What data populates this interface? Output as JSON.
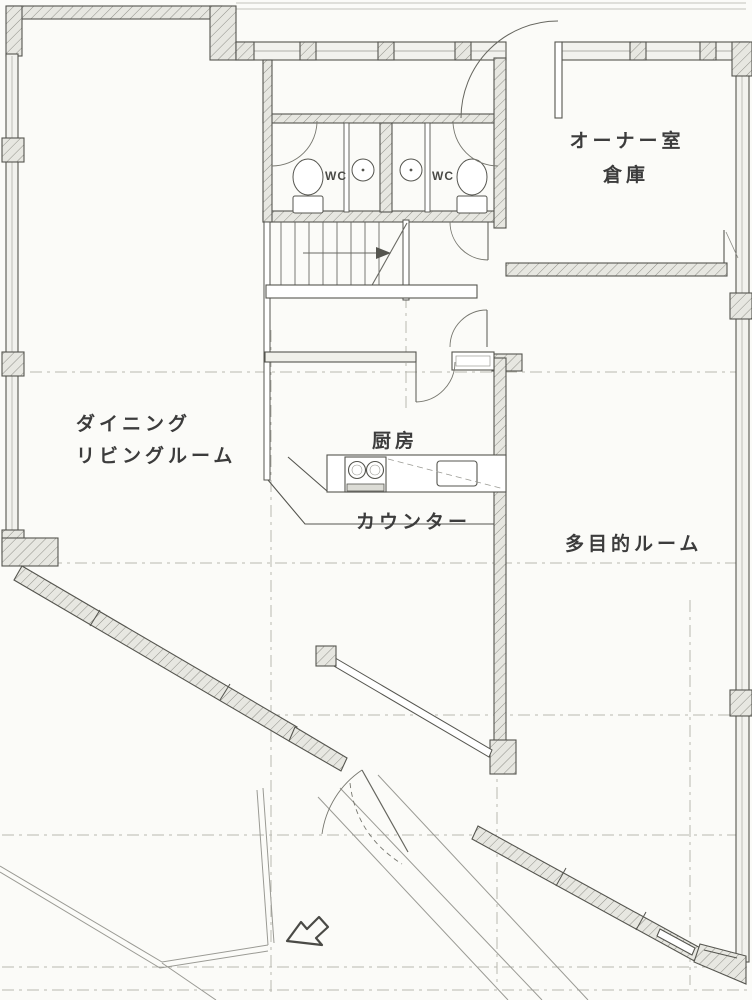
{
  "plan": {
    "rooms": {
      "owner_room": "オーナー室",
      "storage": "倉庫",
      "dining_line1": "ダイニング",
      "dining_line2": "リビングルーム",
      "kitchen": "厨房",
      "counter": "カウンター",
      "multipurpose_room": "多目的ルーム",
      "wc_left": "WC",
      "wc_right": "WC"
    },
    "icons": [
      "entrance-arrow-icon",
      "stair-up-arrow-icon",
      "toilet-icon",
      "basin-icon"
    ],
    "colors": {
      "paper": "#fbfbf8",
      "line": "#55554f",
      "wall_fill": "#e7e7e1",
      "hatch_line": "#8f8f88",
      "grid_line": "#b8b8b0",
      "text": "#3c3c3c"
    }
  }
}
